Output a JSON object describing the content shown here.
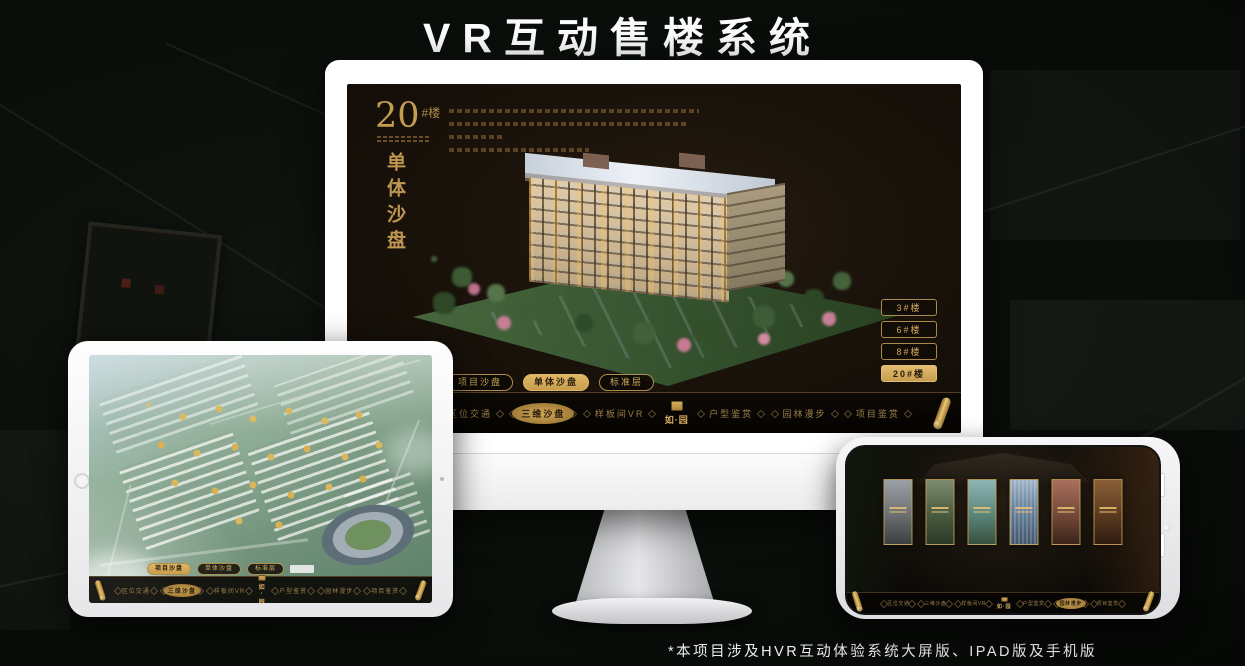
{
  "page": {
    "title": "VR互动售楼系统",
    "footnote": "*本项目涉及HVR互动体验系统大屏版、IPAD版及手机版"
  },
  "colors": {
    "gold": "#cda55c",
    "gold_bright": "#e3bd70",
    "screen_bg": "#1a130b",
    "page_bg": "#0a0e0a"
  },
  "nav": {
    "logo": "如·园",
    "items": [
      "区位交通",
      "三维沙盘",
      "样板间VR",
      "户型鉴赏",
      "园林漫步",
      "项目鉴赏"
    ]
  },
  "monitor": {
    "headline_number": "20",
    "headline_suffix": "#楼",
    "headline_vertical": "单体沙盘",
    "tabs": [
      "项目沙盘",
      "单体沙盘",
      "标准层"
    ],
    "active_tab": "单体沙盘",
    "building_buttons": [
      "3#楼",
      "6#楼",
      "8#楼",
      "20#楼"
    ],
    "active_building": "20#楼",
    "active_nav": "三维沙盘"
  },
  "tablet": {
    "tabs": [
      "项目沙盘",
      "单体沙盘",
      "标准层"
    ],
    "active_tab": "项目沙盘",
    "active_nav": "三维沙盘"
  },
  "phone": {
    "active_nav": "园林漫步",
    "gallery_card_count": 6
  }
}
